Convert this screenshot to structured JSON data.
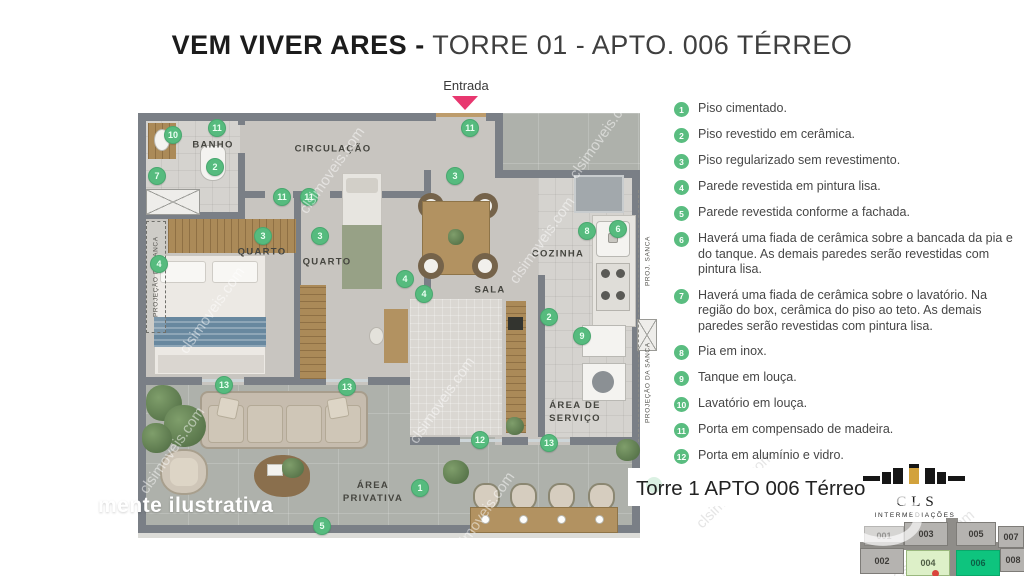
{
  "title": {
    "brand": "VEM VIVER ARES -",
    "unit": " TORRE 01 - APTO. 006 TÉRREO"
  },
  "entrance": {
    "label": "Entrada"
  },
  "watermark_text": "clsimoveis.com",
  "disclaimer": "mente ilustrativa",
  "caption": "Torre 1 APTO 006 Térreo",
  "logo": {
    "name": "CLS",
    "subtitle": "INTERMEDIAÇÕES"
  },
  "colors": {
    "marker_green": "#56bb7e",
    "legend_green": "#5abd80",
    "entrance_pink": "#e8376f",
    "wall_gray": "#7a7f86",
    "floor_interior": "#c8c5c0",
    "floor_tile": "#d5d3cf",
    "floor_patio": "#aeb1ab",
    "minimap_highlight": "#0ec47e",
    "minimap_secondary": "#ddf0c8",
    "logo_gold": "#d2a23c"
  },
  "rooms": [
    {
      "label": "BANHO",
      "x": 83,
      "y": 51
    },
    {
      "label": "CIRCULAÇÃO",
      "x": 203,
      "y": 55
    },
    {
      "label": "QUARTO",
      "x": 132,
      "y": 158
    },
    {
      "label": "QUARTO",
      "x": 197,
      "y": 168
    },
    {
      "label": "SALA",
      "x": 360,
      "y": 196
    },
    {
      "label": "COZINHA",
      "x": 428,
      "y": 160
    },
    {
      "label": "ÁREA DE\nSERVIÇO",
      "x": 445,
      "y": 318
    },
    {
      "label": "ÁREA\nPRIVATIVA",
      "x": 243,
      "y": 398
    }
  ],
  "annotations": [
    {
      "text": "PROJEÇÃO DA SANCA",
      "x": 16,
      "y": 126,
      "w": 20,
      "h": 112,
      "cls": "dash"
    },
    {
      "text": "PROJ. SANCA",
      "x": 509,
      "y": 112,
      "w": 18,
      "h": 108
    },
    {
      "text": "PROJEÇÃO DA SANCA",
      "x": 509,
      "y": 232,
      "w": 18,
      "h": 112
    }
  ],
  "markers": [
    {
      "n": "10",
      "x": 43,
      "y": 40
    },
    {
      "n": "11",
      "x": 87,
      "y": 33
    },
    {
      "n": "7",
      "x": 27,
      "y": 81
    },
    {
      "n": "2",
      "x": 85,
      "y": 72
    },
    {
      "n": "11",
      "x": 152,
      "y": 102
    },
    {
      "n": "11",
      "x": 179,
      "y": 102
    },
    {
      "n": "3",
      "x": 133,
      "y": 141
    },
    {
      "n": "3",
      "x": 190,
      "y": 141
    },
    {
      "n": "4",
      "x": 29,
      "y": 169
    },
    {
      "n": "11",
      "x": 340,
      "y": 33
    },
    {
      "n": "3",
      "x": 325,
      "y": 81
    },
    {
      "n": "4",
      "x": 275,
      "y": 184
    },
    {
      "n": "4",
      "x": 294,
      "y": 199
    },
    {
      "n": "8",
      "x": 457,
      "y": 136
    },
    {
      "n": "6",
      "x": 488,
      "y": 134
    },
    {
      "n": "2",
      "x": 419,
      "y": 222
    },
    {
      "n": "9",
      "x": 452,
      "y": 241
    },
    {
      "n": "13",
      "x": 94,
      "y": 290
    },
    {
      "n": "13",
      "x": 217,
      "y": 292
    },
    {
      "n": "12",
      "x": 350,
      "y": 345
    },
    {
      "n": "13",
      "x": 419,
      "y": 348
    },
    {
      "n": "1",
      "x": 290,
      "y": 393
    },
    {
      "n": "5",
      "x": 192,
      "y": 431
    }
  ],
  "legend": {
    "items": [
      {
        "num": "1",
        "text": "Piso cimentado."
      },
      {
        "num": "2",
        "text": "Piso revestido em cerâmica."
      },
      {
        "num": "3",
        "text": "Piso regularizado sem revestimento."
      },
      {
        "num": "4",
        "text": "Parede revestida em pintura lisa."
      },
      {
        "num": "5",
        "text": "Parede revestida conforme a fachada."
      },
      {
        "num": "6",
        "text": "Haverá uma fiada de cerâmica sobre a bancada da pia e do tanque. As demais paredes serão revestidas com pintura lisa."
      },
      {
        "num": "7",
        "text": "Haverá uma fiada de cerâmica sobre o lavatório. Na região do box, cerâmica do piso ao teto. As demais paredes serão revestidas com pintura lisa."
      },
      {
        "num": "8",
        "text": "Pia em inox."
      },
      {
        "num": "9",
        "text": "Tanque em louça."
      },
      {
        "num": "10",
        "text": "Lavatório em louça."
      },
      {
        "num": "11",
        "text": "Porta em compensado de madeira."
      },
      {
        "num": "12",
        "text": "Porta em alumínio e vidro."
      }
    ]
  },
  "minimap": {
    "units": [
      {
        "id": "001",
        "x": 6,
        "y": 8,
        "w": 40,
        "h": 20,
        "cls": "faded"
      },
      {
        "id": "003",
        "x": 46,
        "y": 4,
        "w": 44,
        "h": 24
      },
      {
        "id": "005",
        "x": 98,
        "y": 4,
        "w": 40,
        "h": 24
      },
      {
        "id": "007",
        "x": 140,
        "y": 8,
        "w": 26,
        "h": 22
      },
      {
        "id": "002",
        "x": 2,
        "y": 30,
        "w": 44,
        "h": 26
      },
      {
        "id": "004",
        "x": 48,
        "y": 32,
        "w": 44,
        "h": 26,
        "cls": "lightgreen"
      },
      {
        "id": "006",
        "x": 98,
        "y": 32,
        "w": 44,
        "h": 26,
        "cls": "green"
      },
      {
        "id": "008",
        "x": 142,
        "y": 30,
        "w": 26,
        "h": 24
      }
    ]
  },
  "watermarks": [
    {
      "x": 190,
      "y": 340,
      "rot": -55
    },
    {
      "x": 310,
      "y": 200,
      "rot": -55
    },
    {
      "x": 150,
      "y": 480,
      "rot": -55
    },
    {
      "x": 420,
      "y": 430,
      "rot": -55
    },
    {
      "x": 520,
      "y": 270,
      "rot": -55
    },
    {
      "x": 460,
      "y": 545,
      "rot": -55
    },
    {
      "x": 580,
      "y": 165,
      "rot": -55
    },
    {
      "x": 705,
      "y": 515,
      "rot": -45,
      "cls": "dark"
    },
    {
      "x": 900,
      "y": 568,
      "rot": -40,
      "cls": "dark"
    }
  ]
}
